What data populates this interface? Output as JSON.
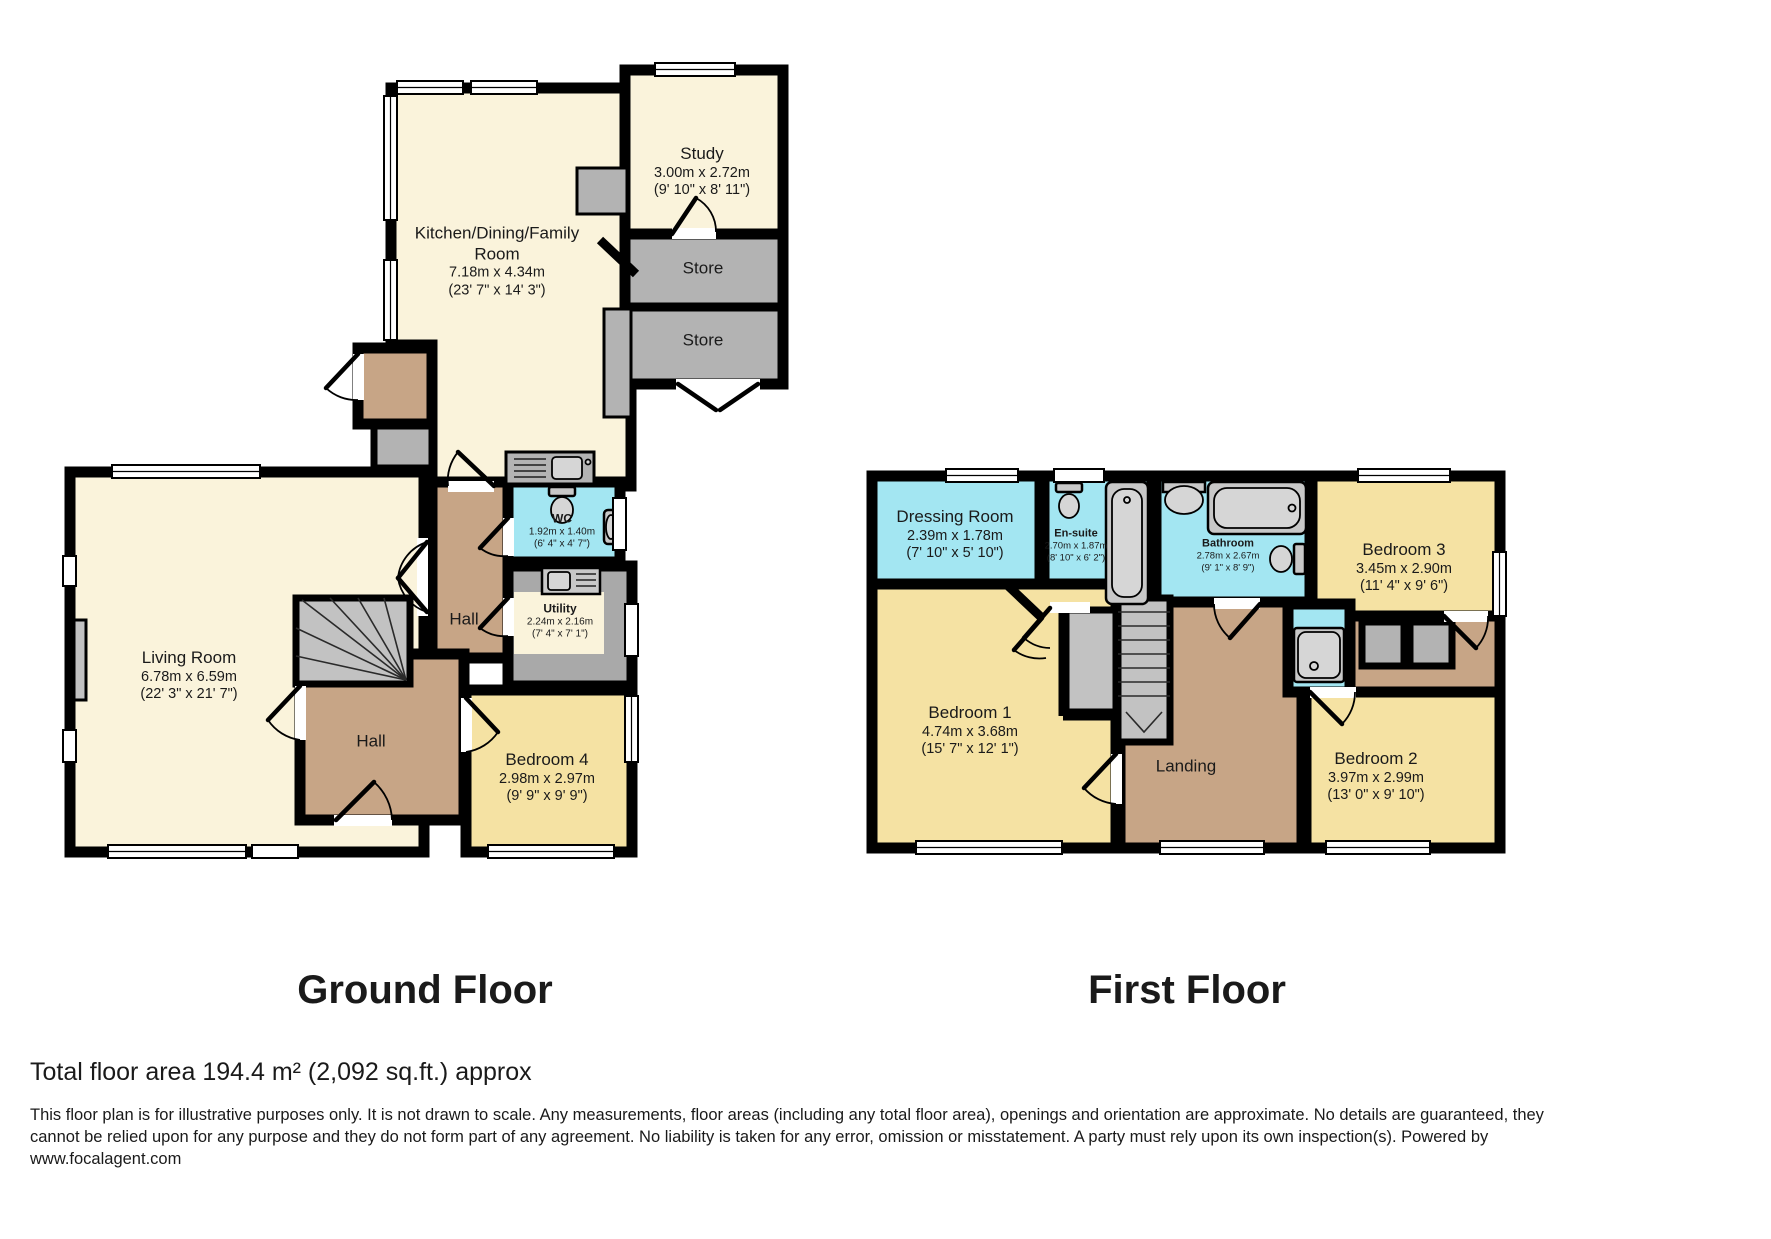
{
  "titles": {
    "ground": "Ground Floor",
    "first": "First Floor"
  },
  "footer": {
    "total_area": "Total floor area 194.4 m² (2,092 sq.ft.) approx",
    "disclaimer": "This floor plan is for illustrative purposes only. It is not drawn to scale. Any measurements, floor areas (including any total floor area), openings and orientation are approximate. No details are guaranteed, they cannot be relied upon for any purpose and they do not form part of any agreement. No liability is taken for any error, omission or misstatement. A party must rely upon its own inspection(s). Powered by www.focalagent.com"
  },
  "ground": {
    "kitchen": {
      "name": "Kitchen/Dining/Family Room",
      "metric": "7.18m x 4.34m",
      "imperial": "(23' 7\" x 14' 3\")"
    },
    "study": {
      "name": "Study",
      "metric": "3.00m x 2.72m",
      "imperial": "(9' 10\" x 8' 11\")"
    },
    "store_upper": {
      "name": "Store"
    },
    "store_lower": {
      "name": "Store"
    },
    "wc": {
      "name": "WC",
      "metric": "1.92m x 1.40m",
      "imperial": "(6' 4\" x 4' 7\")"
    },
    "utility": {
      "name": "Utility",
      "metric": "2.24m x 2.16m",
      "imperial": "(7' 4\" x 7' 1\")"
    },
    "hall_upper": {
      "name": "Hall"
    },
    "hall_lower": {
      "name": "Hall"
    },
    "living": {
      "name": "Living Room",
      "metric": "6.78m x 6.59m",
      "imperial": "(22' 3\" x 21' 7\")"
    },
    "bedroom4": {
      "name": "Bedroom 4",
      "metric": "2.98m x 2.97m",
      "imperial": "(9' 9\" x 9' 9\")"
    }
  },
  "first": {
    "dressing": {
      "name": "Dressing Room",
      "metric": "2.39m x 1.78m",
      "imperial": "(7' 10\" x 5' 10\")"
    },
    "ensuite": {
      "name": "En-suite",
      "metric": "2.70m x 1.87m",
      "imperial": "(8' 10\" x 6' 2\")"
    },
    "bathroom": {
      "name": "Bathroom",
      "metric": "2.78m x 2.67m",
      "imperial": "(9' 1\" x 8' 9\")"
    },
    "bedroom3": {
      "name": "Bedroom 3",
      "metric": "3.45m x 2.90m",
      "imperial": "(11' 4\" x 9' 6\")"
    },
    "bedroom1": {
      "name": "Bedroom 1",
      "metric": "4.74m x 3.68m",
      "imperial": "(15' 7\" x 12' 1\")"
    },
    "landing": {
      "name": "Landing"
    },
    "bedroom2": {
      "name": "Bedroom 2",
      "metric": "3.97m x 2.99m",
      "imperial": "(13' 0\" x 9' 10\")"
    }
  },
  "colors": {
    "room_cream": "#FAF3DB",
    "room_yellow": "#F5E2A3",
    "room_brown": "#C7A586",
    "room_cyan": "#A3E6F2",
    "room_gray": "#B3B3B3",
    "wall": "#000000"
  }
}
